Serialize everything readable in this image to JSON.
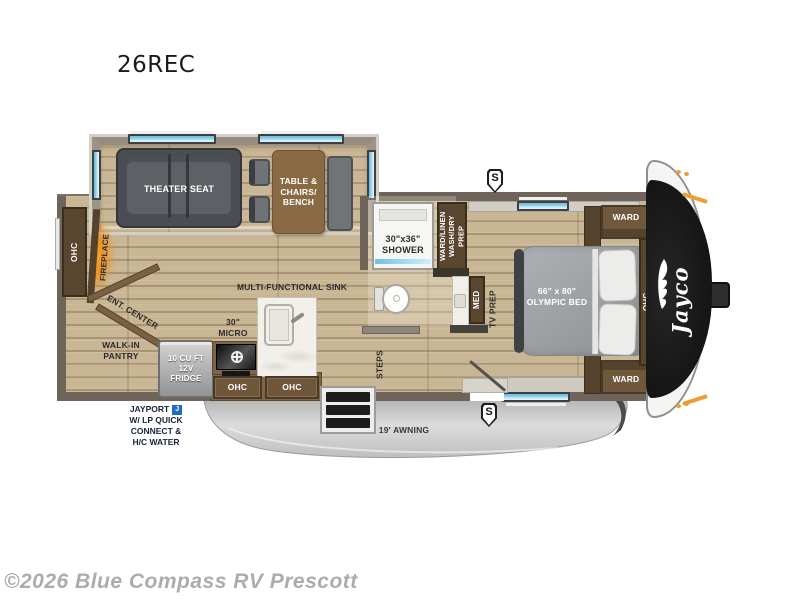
{
  "title": "26REC",
  "watermark": "©2026 Blue Compass RV Prescott",
  "brand": {
    "logo_text": "Jayco"
  },
  "badges": {
    "speaker": "S",
    "jayport_j": "J"
  },
  "living": {
    "theater_seat": "THEATER SEAT",
    "dinette_lines": [
      "TABLE &",
      "CHAIRS/",
      "BENCH"
    ],
    "fireplace": "FIREPLACE",
    "rear_ohc": "OHC",
    "ent_center": "ENT. CENTER",
    "pantry_lines": [
      "WALK-IN",
      "PANTRY"
    ]
  },
  "kitchen": {
    "sink_label": "MULTI-FUNCTIONAL SINK",
    "micro_lines": [
      "30\"",
      "MICRO"
    ],
    "fridge_lines": [
      "10 CU FT",
      "12V",
      "FRIDGE"
    ],
    "ohc_left": "OHC",
    "ohc_right": "OHC"
  },
  "bath": {
    "shower_lines": [
      "30\"x36\"",
      "SHOWER"
    ],
    "ward_linen_lines": [
      "WARD/LINEN",
      "WASH/DRY PREP"
    ],
    "med": "MED",
    "tv_prep": "TV PREP",
    "steps": "STEPS"
  },
  "bedroom": {
    "bed_lines": [
      "66\" x 80\"",
      "OLYMPIC BED"
    ],
    "ward_top": "WARD",
    "ward_bottom": "WARD",
    "ohc": "OHC"
  },
  "exterior": {
    "awning": "19' AWNING",
    "jayport_line1": "JAYPORT",
    "jayport_lines": [
      "W/ LP QUICK",
      "CONNECT &",
      "H/C WATER"
    ]
  },
  "colors": {
    "window_blue": "#6ec3e4",
    "accent_orange": "#ef9c30",
    "fireplace_glow": "#f7a830",
    "jayport_badge_blue": "#1c6fbe",
    "wall_gray": "#6e6459",
    "wood_floor": "#c9b694",
    "cabinet_brown": "#6f5638",
    "front_cap_black": "#141414",
    "awning_gray": "#c9c9c9"
  }
}
